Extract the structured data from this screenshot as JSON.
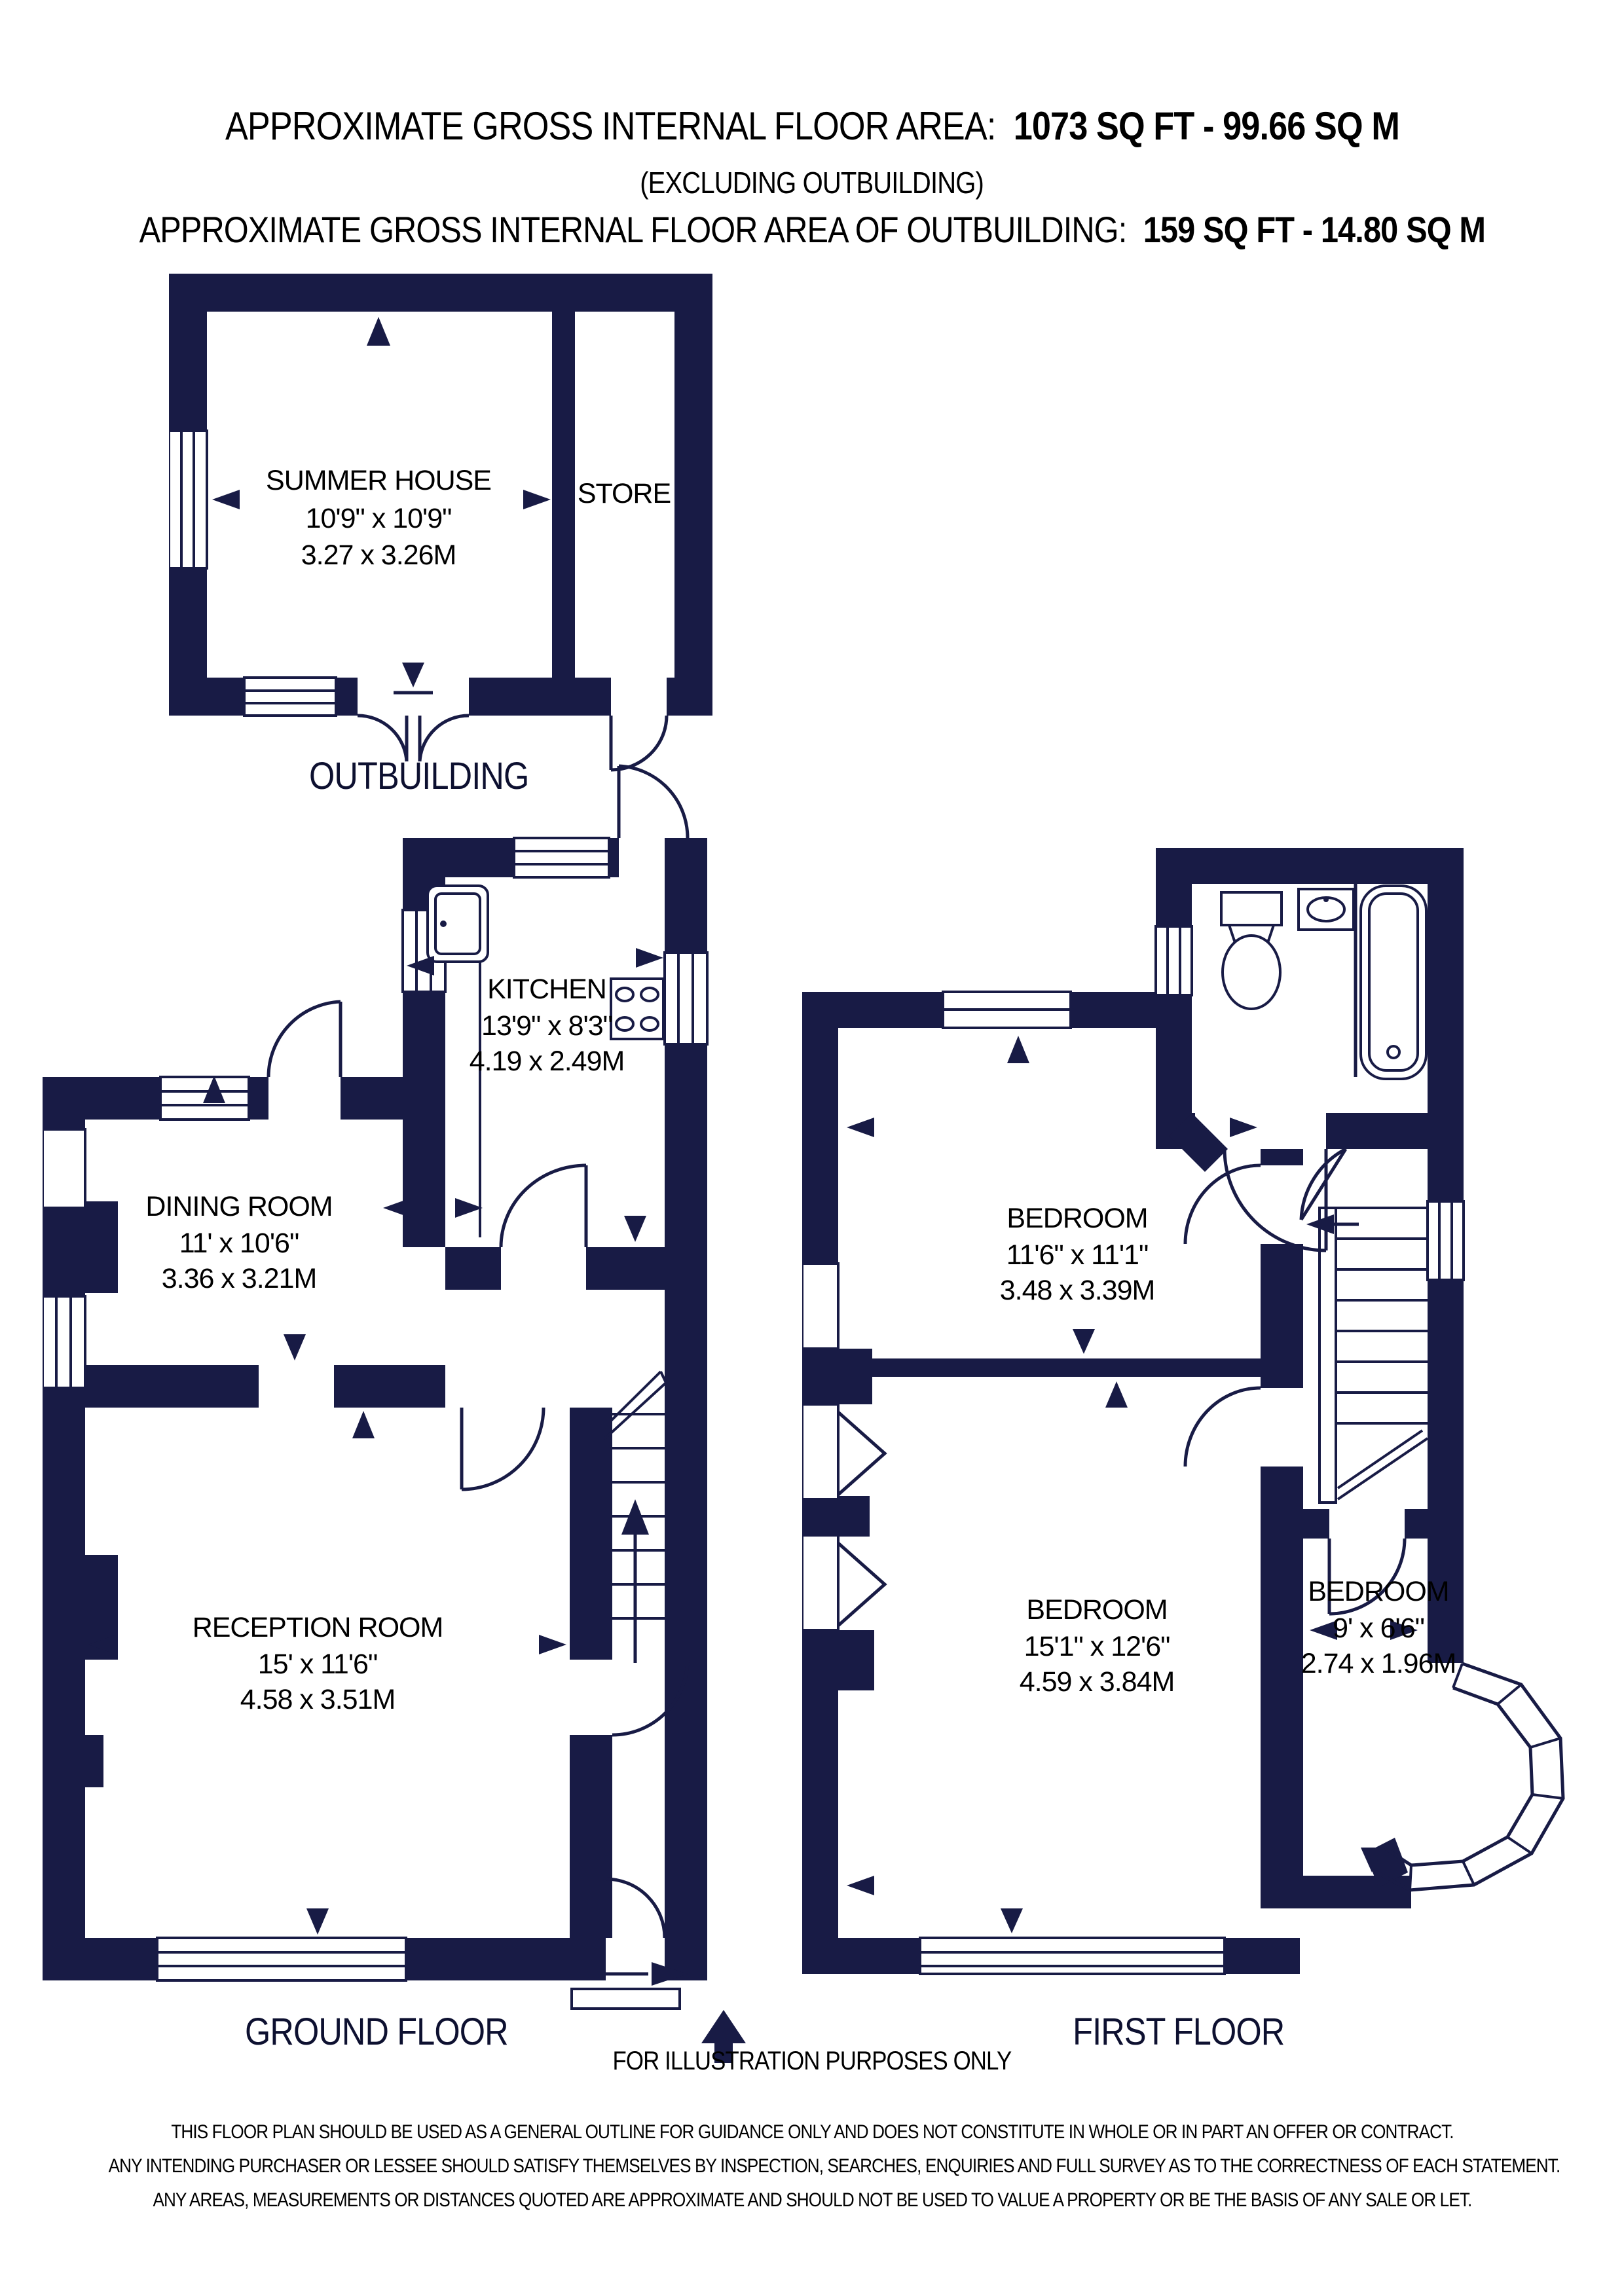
{
  "header": {
    "line1_label": "APPROXIMATE GROSS INTERNAL FLOOR AREA:",
    "line1_value": "1073 SQ FT  -  99.66 SQ M",
    "line2": "(EXCLUDING OUTBUILDING)",
    "line3_label": "APPROXIMATE GROSS INTERNAL FLOOR AREA OF OUTBUILDING:",
    "line3_value": "159 SQ FT  -  14.80 SQ M"
  },
  "outbuilding": {
    "label": "OUTBUILDING",
    "rooms": {
      "summer_house": {
        "name": "SUMMER HOUSE",
        "imperial": "10'9\" x 10'9\"",
        "metric": "3.27 x 3.26M"
      },
      "store": {
        "name": "STORE"
      }
    }
  },
  "ground_floor": {
    "label": "GROUND FLOOR",
    "rooms": {
      "kitchen": {
        "name": "KITCHEN",
        "imperial": "13'9\" x 8'3\"",
        "metric": "4.19 x 2.49M"
      },
      "dining_room": {
        "name": "DINING ROOM",
        "imperial": "11' x 10'6\"",
        "metric": "3.36 x 3.21M"
      },
      "reception_room": {
        "name": "RECEPTION ROOM",
        "imperial": "15' x 11'6\"",
        "metric": "4.58 x 3.51M"
      }
    }
  },
  "first_floor": {
    "label": "FIRST FLOOR",
    "rooms": {
      "bedroom1": {
        "name": "BEDROOM",
        "imperial": "11'6\" x 11'1\"",
        "metric": "3.48 x 3.39M"
      },
      "bedroom2": {
        "name": "BEDROOM",
        "imperial": "15'1\" x 12'6\"",
        "metric": "4.59 x 3.84M"
      },
      "bedroom3": {
        "name": "BEDROOM",
        "imperial": "9' x 6'6\"",
        "metric": "2.74 x 1.96M"
      }
    }
  },
  "footer": {
    "illustration_note": "FOR ILLUSTRATION PURPOSES ONLY",
    "disclaimer_line1": "THIS FLOOR PLAN SHOULD BE USED AS A GENERAL OUTLINE FOR GUIDANCE ONLY AND DOES NOT CONSTITUTE IN WHOLE OR IN PART AN OFFER OR CONTRACT.",
    "disclaimer_line2": "ANY INTENDING PURCHASER OR LESSEE SHOULD SATISFY THEMSELVES BY INSPECTION, SEARCHES, ENQUIRIES AND FULL SURVEY AS TO THE CORRECTNESS OF EACH STATEMENT.",
    "disclaimer_line3": "ANY AREAS, MEASUREMENTS OR DISTANCES QUOTED ARE APPROXIMATE AND SHOULD NOT BE USED TO VALUE A PROPERTY OR BE THE BASIS OF ANY SALE OR LET."
  },
  "colors": {
    "wall": "#181b45",
    "text": "#000000"
  }
}
